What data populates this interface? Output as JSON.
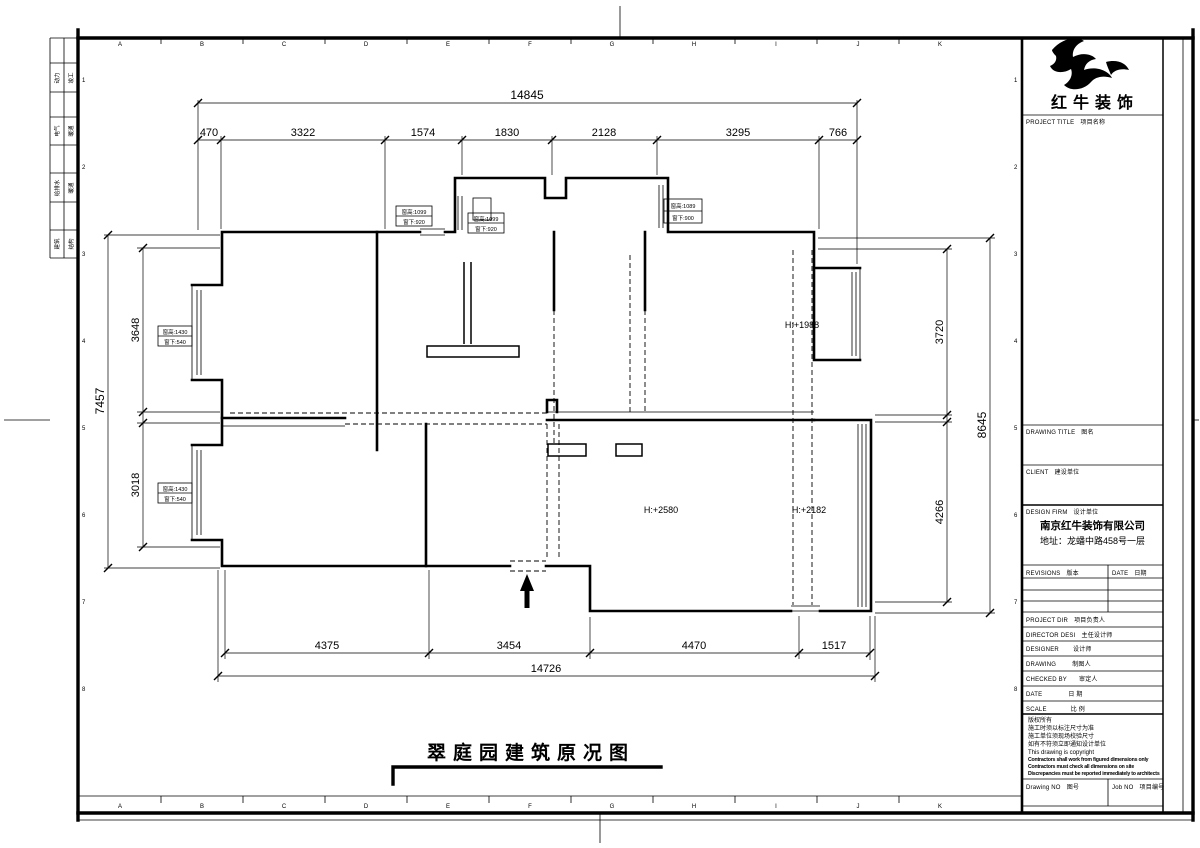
{
  "brand": {
    "company": "红牛装饰"
  },
  "drawing": {
    "title": "翠庭园建筑原况图",
    "height_labels": [
      "H:+1988",
      "H:+2580",
      "H:+2182"
    ],
    "window_tags": [
      {
        "line1": "窗高:1430",
        "line2": "窗下:540"
      },
      {
        "line1": "窗高:1430",
        "line2": "窗下:540"
      },
      {
        "line1": "窗高:1099",
        "line2": "窗下:920"
      },
      {
        "line1": "窗高:1099",
        "line2": "窗下:920"
      },
      {
        "line1": "窗高:1089",
        "line2": "窗下:900"
      }
    ]
  },
  "dimensions": {
    "top_overall": "14845",
    "top_segments": [
      "470",
      "3322",
      "1574",
      "1830",
      "2128",
      "3295",
      "766"
    ],
    "bottom_segments": [
      "4375",
      "3454",
      "4470",
      "1517"
    ],
    "bottom_overall": "14726",
    "left_overall": "7457",
    "left_segments": [
      "3648",
      "3018"
    ],
    "right_segments": [
      "3720",
      "4266"
    ],
    "right_overall": "8645"
  },
  "rulers": {
    "top_letters": [
      "A",
      "B",
      "C",
      "D",
      "E",
      "F",
      "G",
      "H",
      "I",
      "J",
      "K"
    ],
    "bottom_letters": [
      "A",
      "B",
      "C",
      "D",
      "E",
      "F",
      "G",
      "H",
      "I",
      "J",
      "K"
    ],
    "left_numbers": [
      "1",
      "2",
      "3",
      "4",
      "5",
      "6",
      "7",
      "8"
    ],
    "right_numbers": [
      "1",
      "2",
      "3",
      "4",
      "5",
      "6",
      "7",
      "8"
    ]
  },
  "margin_strip": {
    "rows": [
      {
        "a": "动力",
        "b": "竣工"
      },
      {
        "a": "电气",
        "b": "暖通"
      },
      {
        "a": "给排水",
        "b": "暖通"
      },
      {
        "a": "建筑",
        "b": "结构"
      }
    ]
  },
  "title_block": {
    "project_title_label": "PROJECT TITLE",
    "project_title_cn": "项目名称",
    "drawing_title_label": "DRAWING TITLE",
    "drawing_title_cn": "图名",
    "client_label": "CLIENT",
    "client_cn": "建设单位",
    "design_firm_label": "DESIGN FIRM",
    "design_firm_cn": "设计单位",
    "design_firm_name": "南京红牛装饰有限公司",
    "design_firm_address": "地址：龙蟠中路458号一层",
    "revisions_label": "REVISIONS",
    "revisions_cn": "版本",
    "date_col_label": "DATE",
    "date_col_cn": "日期",
    "project_dir_label": "PROJECT DIR",
    "project_dir_cn": "项目负责人",
    "director_label": "DIRECTOR DESI",
    "director_cn": "主任设计师",
    "designer_label": "DESIGNER",
    "designer_cn": "设计师",
    "drawing_label": "DRAWING",
    "drawing_cn": "制图人",
    "checked_label": "CHECKED BY",
    "checked_cn": "审定人",
    "date_label": "DATE",
    "date_cn": "日 期",
    "scale_label": "SCALE",
    "scale_cn": "比 例",
    "copyright_lines": [
      "版权所有",
      "施工时须以标注尺寸为准",
      "施工单位须现场校验尺寸",
      "如有不符须立即通知设计单位",
      "This drawing is copyright"
    ],
    "copyright_en_lines": [
      "Contractors shall work from figured dimensions only",
      "Contractors must check all dimensions on site",
      "Discrepancies must be reported immediately to architects"
    ],
    "drawing_no_label": "Drawing NO",
    "drawing_no_cn": "图号",
    "job_no_label": "Job NO",
    "job_no_cn": "项目编号"
  }
}
